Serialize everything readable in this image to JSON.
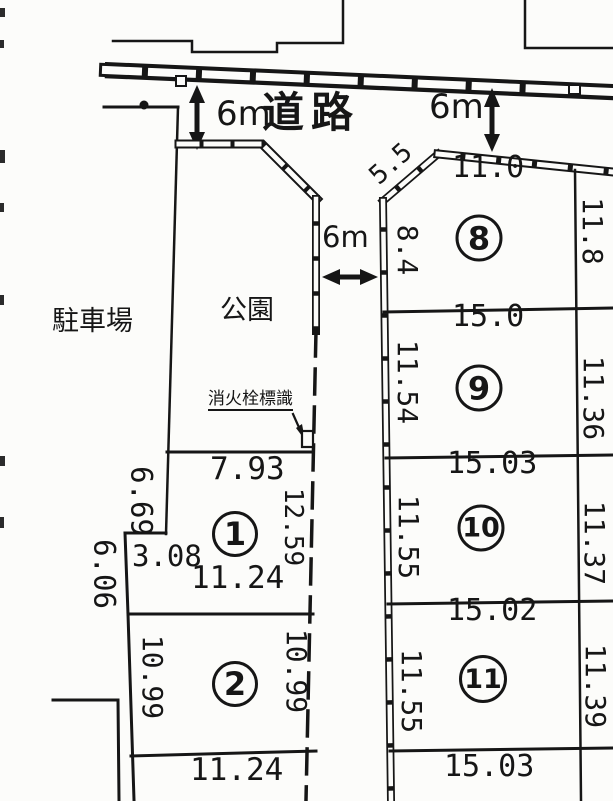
{
  "labels": {
    "road": "道路",
    "park": "公園",
    "parking": "駐車場",
    "hydrant_sign": "消火栓標識"
  },
  "widths": {
    "top_left": "6m",
    "top_right": "6m",
    "middle": "6m"
  },
  "chamfer": "5.5",
  "plots": {
    "p1": {
      "number": "1",
      "top": "7.93",
      "left_upper": "6.69",
      "step": "3.08",
      "left_lower": "6.06",
      "right": "12.59",
      "bottom": "11.24"
    },
    "p2": {
      "number": "2",
      "left": "10.99",
      "right": "10.99",
      "bottom": "11.24"
    },
    "p8": {
      "number": "8",
      "top": "11.0",
      "left": "8.4",
      "right": "11.8"
    },
    "p9": {
      "number": "9",
      "top": "15.0",
      "left": "11.54",
      "right": "11.36"
    },
    "p10": {
      "number": "10",
      "top": "15.03",
      "left": "11.55",
      "right": "11.37"
    },
    "p11": {
      "number": "11",
      "top": "15.02",
      "left": "11.55",
      "right": "11.39",
      "bottom": "15.03"
    }
  }
}
